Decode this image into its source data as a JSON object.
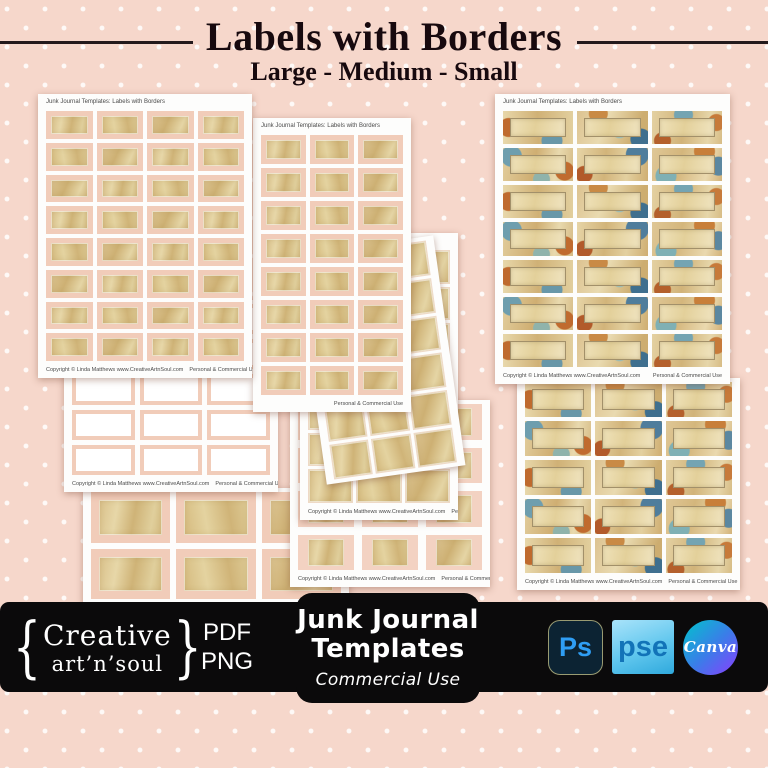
{
  "header": {
    "title": "Labels with Borders",
    "subtitle": "Large - Medium - Small"
  },
  "sheet_text": {
    "header": "Junk Journal Templates: Labels with Borders",
    "footer_left": "Copyright © Linda Matthews www.CreativeArtnSoul.com",
    "footer_right": "Personal & Commercial Use"
  },
  "sheets": [
    {
      "id": "top-left",
      "x": 38,
      "y": 94,
      "w": 214,
      "h": 284,
      "z": 50,
      "rot": 0,
      "cols": 4,
      "rows": 8,
      "style": "sp",
      "gap": 4,
      "header": true,
      "fl": true,
      "fr": true
    },
    {
      "id": "center",
      "x": 253,
      "y": 118,
      "w": 158,
      "h": 294,
      "z": 40,
      "rot": 0,
      "cols": 3,
      "rows": 8,
      "style": "sp",
      "gap": 4,
      "header": true,
      "fl": false,
      "fr": true
    },
    {
      "id": "mid-tilt",
      "x": 310,
      "y": 244,
      "w": 140,
      "h": 232,
      "z": 30,
      "rot": -8,
      "cols": 3,
      "rows": 6,
      "style": "gd",
      "gap": 3,
      "header": false,
      "fl": false,
      "fr": false
    },
    {
      "id": "mid-back",
      "x": 300,
      "y": 233,
      "w": 158,
      "h": 287,
      "z": 20,
      "rot": 0,
      "cols": 3,
      "rows": 7,
      "style": "gd",
      "gap": 3,
      "header": true,
      "fl": true,
      "fr": true
    },
    {
      "id": "bottom-center",
      "x": 290,
      "y": 400,
      "w": 200,
      "h": 187,
      "z": 16,
      "rot": 0,
      "cols": 3,
      "rows": 4,
      "style": "sg",
      "gap": 8,
      "header": false,
      "fl": true,
      "fr": true
    },
    {
      "id": "left-mid",
      "x": 64,
      "y": 300,
      "w": 214,
      "h": 192,
      "z": 25,
      "rot": 0,
      "cols": 3,
      "rows": 5,
      "style": "fr",
      "gap": 5,
      "header": false,
      "fl": true,
      "fr": true
    },
    {
      "id": "bottom-left",
      "x": 83,
      "y": 488,
      "w": 266,
      "h": 115,
      "z": 15,
      "rot": 0,
      "cols": 3,
      "rows": 2,
      "style": "bf",
      "gap": 6,
      "header": false,
      "fl": false,
      "fr": false
    },
    {
      "id": "top-right",
      "x": 495,
      "y": 94,
      "w": 235,
      "h": 290,
      "z": 50,
      "rot": 0,
      "cols": 3,
      "rows": 7,
      "style": "dec",
      "gap": 4,
      "header": true,
      "fl": true,
      "fr": true
    },
    {
      "id": "bottom-right",
      "x": 517,
      "y": 378,
      "w": 223,
      "h": 212,
      "z": 40,
      "rot": 0,
      "cols": 3,
      "rows": 5,
      "style": "dec",
      "gap": 4,
      "header": false,
      "fl": true,
      "fr": true
    }
  ],
  "footer": {
    "brand": {
      "brace_left": "{",
      "line1": "Creative",
      "line2": "art’n’soul",
      "brace_right": "}"
    },
    "formats": [
      "PDF",
      "PNG"
    ],
    "badge": {
      "line1": "Junk Journal",
      "line2": "Templates",
      "subline": "Commercial Use"
    },
    "apps": [
      {
        "name": "photoshop",
        "label": "Ps"
      },
      {
        "name": "photoshop-elements",
        "label": "pse"
      },
      {
        "name": "canva",
        "label": "Canva"
      }
    ]
  },
  "colors": {
    "background_pink": "#f6d7cb",
    "dot_white": "#ffffff",
    "bar_black": "#0b0a0b",
    "label_gold": "#d5bb81",
    "label_frame_pink": "#f1ccb9",
    "title_black": "#17090e",
    "photoshop_bg": "#0c2333",
    "photoshop_text": "#2f9ef4",
    "pse_text": "#1273b8",
    "canva_teal": "#00c4cc",
    "canva_purple": "#8b3dff"
  }
}
